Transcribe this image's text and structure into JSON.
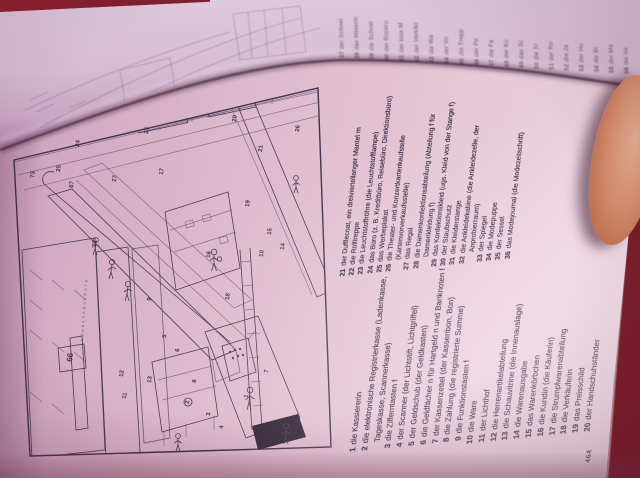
{
  "book": {
    "page_number": "464"
  },
  "colors": {
    "background_maroon": "#7c1f2c",
    "page_pink": "#ddb6c9",
    "ink": "#3a2d42",
    "skin": "#d79272"
  },
  "vocab": {
    "column1": [
      {
        "num": "1",
        "text": "die Kassiererin"
      },
      {
        "num": "2",
        "text": "die elektronische Registrierkasse (Ladenkasse, Tageskasse, Scannerkasse)"
      },
      {
        "num": "3",
        "text": "die Zifferntasten f"
      },
      {
        "num": "4",
        "text": "der Scanner (der Lichtstift, Lichtgriffel)"
      },
      {
        "num": "5",
        "text": "der Geldschub (der Geldkasten)"
      },
      {
        "num": "6",
        "text": "die Geldfächer n für Hartgeld n und Banknoten f"
      },
      {
        "num": "7",
        "text": "der Kassenzettel (der Kassenbon, Bon)"
      },
      {
        "num": "8",
        "text": "die Zahlung (die registrierte Summe)"
      },
      {
        "num": "9",
        "text": "die Funktionstasten f"
      },
      {
        "num": "10",
        "text": "die Ware"
      },
      {
        "num": "11",
        "text": "der Lichthof"
      },
      {
        "num": "12",
        "text": "die Herrenartikelabteilung"
      },
      {
        "num": "13",
        "text": "die Schauvitrine (die Innenauslage)"
      },
      {
        "num": "14",
        "text": "die Warenausgabe"
      },
      {
        "num": "15",
        "text": "das Warenkörbchen"
      },
      {
        "num": "16",
        "text": "die Kundin (die Käuferin)"
      },
      {
        "num": "17",
        "text": "die Strumpfwarenabteilung"
      },
      {
        "num": "18",
        "text": "die Verkäuferin"
      },
      {
        "num": "19",
        "text": "das Preisschild"
      },
      {
        "num": "20",
        "text": "der Handschuhständer"
      }
    ],
    "column2": [
      {
        "num": "21",
        "text": "der Dufflecoat, ein dreiviertellanger Mantel m"
      },
      {
        "num": "22",
        "text": "die Rolltreppe"
      },
      {
        "num": "23",
        "text": "die Leuchtstoffröhre (die Leuchtstofflampe)"
      },
      {
        "num": "24",
        "text": "das Büro (z. B. Kreditbüro, Reisebüro, Direktionsbüro)"
      },
      {
        "num": "25",
        "text": "das Werbeplakat"
      },
      {
        "num": "26",
        "text": "die Theater- und Konzertkartenkaufstelle (Kartenvorverkaufsstelle)"
      },
      {
        "num": "27",
        "text": "das Regal"
      },
      {
        "num": "28",
        "text": "die Damenkonfektionsabteilung (Abteilung f für Damenkleidung f)"
      },
      {
        "num": "29",
        "text": "das Konfektionskleid (ugs. Kleid von der Stange f)"
      },
      {
        "num": "30",
        "text": "der Staubschutz"
      },
      {
        "num": "31",
        "text": "die Kleiderstange"
      },
      {
        "num": "32",
        "text": "die Ankleidekabine (die Ankleidezelle, der Anprobierraum)"
      },
      {
        "num": "33",
        "text": "der Spiegel"
      },
      {
        "num": "34",
        "text": "die Modepuppe"
      },
      {
        "num": "35",
        "text": "der Sessel"
      },
      {
        "num": "36",
        "text": "das Modejournal (die Modezeitschrift)"
      }
    ]
  },
  "facing_fragments": [
    {
      "num": "37",
      "text": "der Schnei"
    },
    {
      "num": "38",
      "text": "das Meterm"
    },
    {
      "num": "39",
      "text": "die Schnei"
    },
    {
      "num": "40",
      "text": "der Rockru"
    },
    {
      "num": "41",
      "text": "der lose M"
    },
    {
      "num": "42",
      "text": "der Verkäu"
    },
    {
      "num": "43",
      "text": "die Wa"
    },
    {
      "num": "44",
      "text": "der Vo"
    },
    {
      "num": "45",
      "text": "die Trepp"
    },
    {
      "num": "46",
      "text": "der Pe"
    },
    {
      "num": "47",
      "text": "die Fa"
    },
    {
      "num": "48",
      "text": "der Ku"
    },
    {
      "num": "49",
      "text": "das Sc"
    },
    {
      "num": "50",
      "text": "die St"
    },
    {
      "num": "51",
      "text": "der Ro"
    },
    {
      "num": "52",
      "text": "die Ja"
    },
    {
      "num": "53",
      "text": "der Hu"
    },
    {
      "num": "54",
      "text": "die Bl"
    },
    {
      "num": "55",
      "text": "der Ma"
    },
    {
      "num": "56",
      "text": "die Ve"
    }
  ],
  "illustration": {
    "banner_text": "SONDERANGEBOTE",
    "labels": [
      {
        "t": "73",
        "x": 34,
        "y": 178
      },
      {
        "t": "25",
        "x": 60,
        "y": 172
      },
      {
        "t": "24",
        "x": 79,
        "y": 147
      },
      {
        "t": "67",
        "x": 73,
        "y": 188
      },
      {
        "t": "27",
        "x": 116,
        "y": 182
      },
      {
        "t": "17",
        "x": 163,
        "y": 175
      },
      {
        "t": "23",
        "x": 148,
        "y": 134
      },
      {
        "t": "22",
        "x": 96,
        "y": 247
      },
      {
        "t": "20",
        "x": 236,
        "y": 122
      },
      {
        "t": "21",
        "x": 262,
        "y": 152
      },
      {
        "t": "19",
        "x": 249,
        "y": 207
      },
      {
        "t": "26",
        "x": 299,
        "y": 132
      },
      {
        "t": "15",
        "x": 271,
        "y": 235
      },
      {
        "t": "14",
        "x": 284,
        "y": 250
      },
      {
        "t": "10",
        "x": 263,
        "y": 257
      },
      {
        "t": "16",
        "x": 210,
        "y": 258
      },
      {
        "t": "18",
        "x": 229,
        "y": 300
      },
      {
        "t": "66",
        "x": 72,
        "y": 362,
        "big": true
      },
      {
        "t": "12",
        "x": 123,
        "y": 377
      },
      {
        "t": "13",
        "x": 151,
        "y": 383
      },
      {
        "t": "11",
        "x": 126,
        "y": 399
      },
      {
        "t": "9",
        "x": 151,
        "y": 301
      },
      {
        "t": "5",
        "x": 166,
        "y": 338
      },
      {
        "t": "6",
        "x": 179,
        "y": 352
      },
      {
        "t": "8",
        "x": 196,
        "y": 383
      },
      {
        "t": "2",
        "x": 189,
        "y": 404
      },
      {
        "t": "3",
        "x": 210,
        "y": 416
      },
      {
        "t": "4",
        "x": 223,
        "y": 429
      },
      {
        "t": "1",
        "x": 248,
        "y": 398
      },
      {
        "t": "7",
        "x": 268,
        "y": 373
      }
    ]
  }
}
